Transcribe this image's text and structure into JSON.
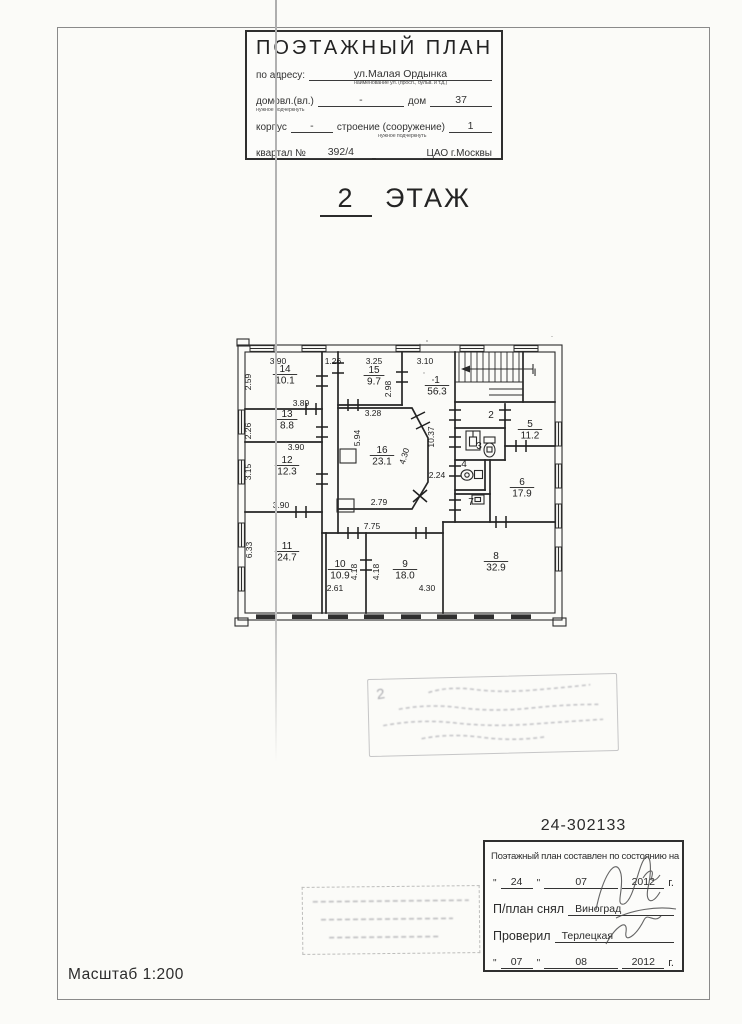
{
  "header": {
    "title": "ПОЭТАЖНЫЙ ПЛАН",
    "address_label": "по адресу:",
    "address_value": "ул.Малая Ордынка",
    "address_hint": "наименование ул. (просп., бульв. и т.д.)",
    "ownership_label": "домовл.(вл.)",
    "ownership_hint": "нужное подчеркнуть",
    "ownership_value": "-",
    "house_label": "дом",
    "house_value": "37",
    "block_label": "корпус",
    "block_value": "-",
    "building_label": "строение (сооружение)",
    "building_hint": "нужное подчеркнуть",
    "building_value": "1",
    "quarter_label": "квартал №",
    "quarter_value": "392/4",
    "district_value": "ЦАО г.Москвы"
  },
  "floor_heading": {
    "number": "2",
    "word": "ЭТАЖ"
  },
  "plan": {
    "stair_label": "I",
    "rooms": [
      {
        "num": "14",
        "area": "10.1",
        "x": 285,
        "y": 372
      },
      {
        "num": "15",
        "area": "9.7",
        "x": 374,
        "y": 373
      },
      {
        "num": "1",
        "area": "56.3",
        "x": 437,
        "y": 383
      },
      {
        "num": "13",
        "area": "8.8",
        "x": 287,
        "y": 417
      },
      {
        "num": "2",
        "area": "",
        "x": 491,
        "y": 418
      },
      {
        "num": "5",
        "area": "11.2",
        "x": 530,
        "y": 427
      },
      {
        "num": "3",
        "area": "",
        "x": 479,
        "y": 449
      },
      {
        "num": "12",
        "area": "12.3",
        "x": 287,
        "y": 463
      },
      {
        "num": "16",
        "area": "23.1",
        "x": 382,
        "y": 453
      },
      {
        "num": "4",
        "area": "",
        "x": 464,
        "y": 467
      },
      {
        "num": "6",
        "area": "17.9",
        "x": 522,
        "y": 485
      },
      {
        "num": "7",
        "area": "",
        "x": 471,
        "y": 505
      },
      {
        "num": "11",
        "area": "24.7",
        "x": 287,
        "y": 549
      },
      {
        "num": "10",
        "area": "10.9",
        "x": 340,
        "y": 567
      },
      {
        "num": "9",
        "area": "18.0",
        "x": 405,
        "y": 567
      },
      {
        "num": "8",
        "area": "32.9",
        "x": 496,
        "y": 559
      }
    ],
    "dims": [
      {
        "text": "3.90",
        "x": 278,
        "y": 364,
        "rot": 0
      },
      {
        "text": "1.26",
        "x": 333,
        "y": 364,
        "rot": 0
      },
      {
        "text": "3.25",
        "x": 374,
        "y": 364,
        "rot": 0
      },
      {
        "text": "3.10",
        "x": 425,
        "y": 364,
        "rot": 0
      },
      {
        "text": "2.59",
        "x": 251,
        "y": 382,
        "rot": -90
      },
      {
        "text": "2.98",
        "x": 391,
        "y": 389,
        "rot": -90
      },
      {
        "text": "3.89",
        "x": 301,
        "y": 406,
        "rot": 0
      },
      {
        "text": "3.28",
        "x": 373,
        "y": 416,
        "rot": 0
      },
      {
        "text": "2.26",
        "x": 251,
        "y": 431,
        "rot": -90
      },
      {
        "text": "5.94",
        "x": 360,
        "y": 438,
        "rot": -90
      },
      {
        "text": "10.37",
        "x": 434,
        "y": 437,
        "rot": -90
      },
      {
        "text": "3.90",
        "x": 296,
        "y": 450,
        "rot": 0
      },
      {
        "text": "4.30",
        "x": 407,
        "y": 457,
        "rot": -73
      },
      {
        "text": "3.15",
        "x": 251,
        "y": 472,
        "rot": -90
      },
      {
        "text": "2.24",
        "x": 437,
        "y": 478,
        "rot": 0
      },
      {
        "text": "2.79",
        "x": 379,
        "y": 505,
        "rot": 0
      },
      {
        "text": "3.90",
        "x": 281,
        "y": 508,
        "rot": 0
      },
      {
        "text": "7.75",
        "x": 372,
        "y": 529,
        "rot": 0
      },
      {
        "text": "6.33",
        "x": 252,
        "y": 550,
        "rot": -90
      },
      {
        "text": "4.18",
        "x": 357,
        "y": 572,
        "rot": -90
      },
      {
        "text": "4.18",
        "x": 379,
        "y": 572,
        "rot": -90
      },
      {
        "text": "2.61",
        "x": 335,
        "y": 591,
        "rot": 0
      },
      {
        "text": "4.30",
        "x": 427,
        "y": 591,
        "rot": 0
      }
    ]
  },
  "stamps": {
    "mark": "2"
  },
  "doc_number": "24-302133",
  "cert_box": {
    "line1": "Поэтажный план составлен по состоянию на",
    "date1": {
      "day": "24",
      "month": "07",
      "year": "2012",
      "suffix": "г."
    },
    "surveyor_label": "П/план снял",
    "surveyor_value": "Виноград",
    "checker_label": "Проверил",
    "checker_value": "Терлецкая",
    "date2": {
      "day": "07",
      "month": "08",
      "year": "2012",
      "suffix": "г."
    }
  },
  "scale_label": "Масштаб 1:200"
}
